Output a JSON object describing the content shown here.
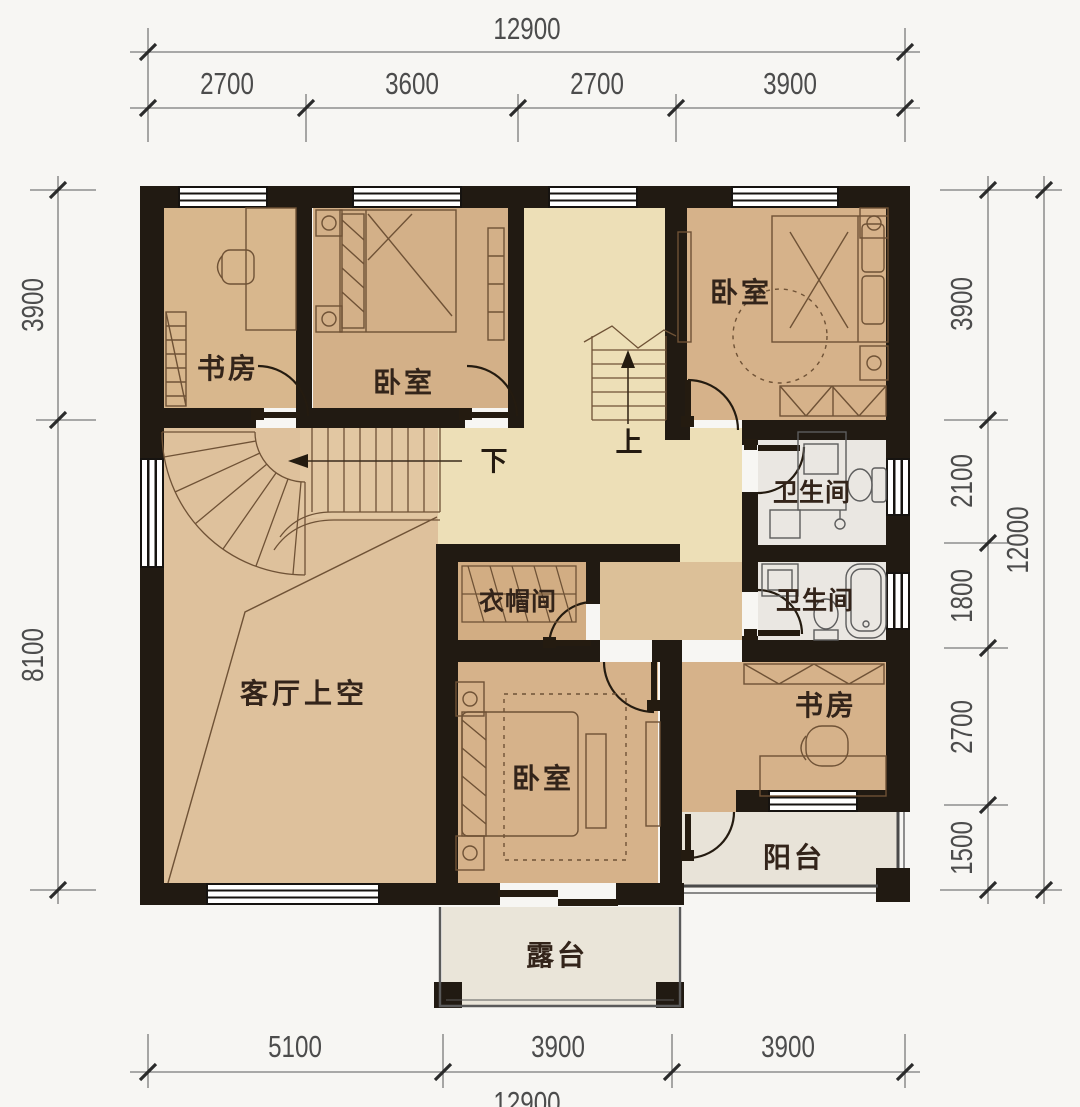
{
  "title": "二层户型平面图",
  "rooms": {
    "study_tl": {
      "label": "书房"
    },
    "bedroom_top": {
      "label": "卧室"
    },
    "bedroom_right": {
      "label": "卧室"
    },
    "bath_upper": {
      "label": "卫生间"
    },
    "bath_lower": {
      "label": "卫生间"
    },
    "closet": {
      "label": "衣帽间"
    },
    "living_void": {
      "label": "客厅上空"
    },
    "bedroom_bottom": {
      "label": "卧室"
    },
    "study_br": {
      "label": "书房"
    },
    "balcony": {
      "label": "阳台"
    },
    "terrace": {
      "label": "露台"
    }
  },
  "stairs": {
    "up_label": "上",
    "down_label": "下"
  },
  "dimensions": {
    "top": {
      "total": "12900",
      "segments": [
        "2700",
        "3600",
        "2700",
        "3900"
      ]
    },
    "bottom": {
      "total": "12900",
      "segments": [
        "5100",
        "3900",
        "3900"
      ]
    },
    "left": {
      "segments": [
        "3900",
        "8100"
      ]
    },
    "right": {
      "total": "12000",
      "segments": [
        "3900",
        "2100",
        "1800",
        "2700",
        "1500"
      ]
    }
  },
  "palette": {
    "wall": "#211a12",
    "room_tan": "#d6b28a",
    "hall_cream": "#eddfb7",
    "living_tan": "#dec19c",
    "bath_gray": "#eae7e2",
    "outdoor_gray": "#e9e4d8",
    "background": "#f7f6f3",
    "furniture_line": "#6f5236",
    "dimension_text": "#4c4c4c"
  }
}
